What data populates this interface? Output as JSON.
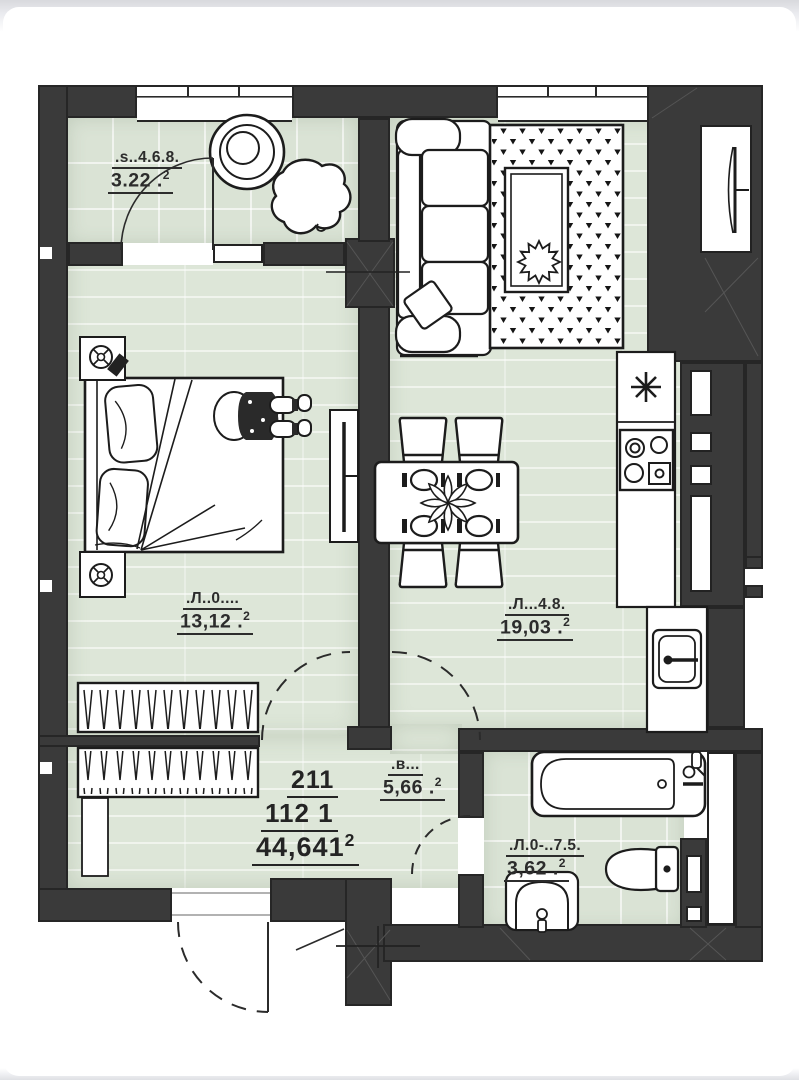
{
  "page": {
    "background": "#ffffff"
  },
  "colors": {
    "wall": "#3a3a3a",
    "floor_green": "#dde6d8",
    "outline": "#1c1c1c",
    "paper": "#ffffff"
  },
  "rooms": {
    "balcony": {
      "label": ".s..4.6.8.",
      "area": "3.22 .",
      "sup": "2"
    },
    "bedroom": {
      "label": ".Л..0....",
      "area": "13,12 .",
      "sup": "2"
    },
    "kitchen_living": {
      "label": ".Л...4.8.",
      "area": "19,03 .",
      "sup": "2"
    },
    "hallway": {
      "label": ".в...",
      "area": "5,66 .",
      "sup": "2"
    },
    "bathroom": {
      "label": ".Л.0-..7.5.",
      "area": "3,62 .",
      "sup": "2"
    },
    "apartment": {
      "number": "211",
      "code": "112  1",
      "total_area": "44,641",
      "sup": "2"
    }
  }
}
